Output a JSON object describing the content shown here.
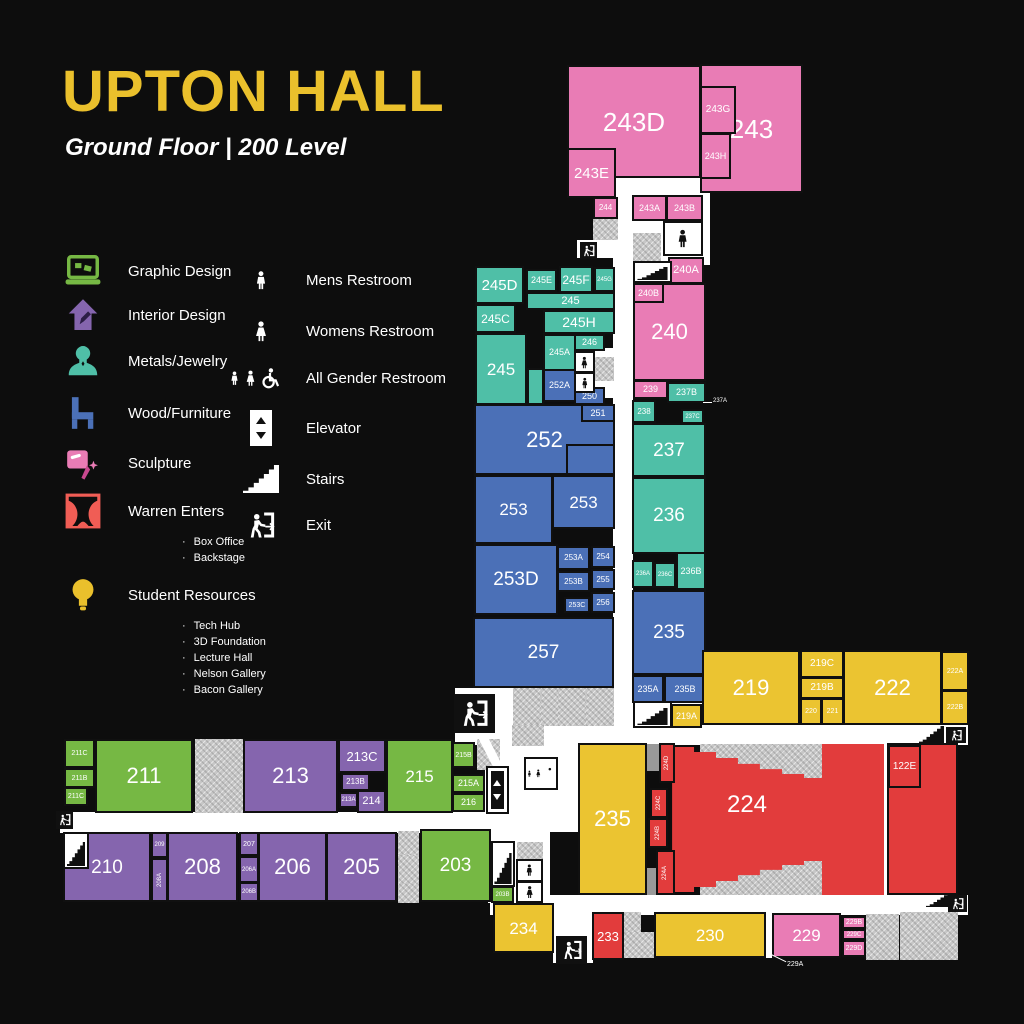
{
  "header": {
    "title": "UPTON HALL",
    "subtitle": "Ground Floor | 200 Level"
  },
  "legend": {
    "programs": [
      {
        "icon": "laptop-icon",
        "label": "Graphic Design",
        "color": "#76b844"
      },
      {
        "icon": "house-icon",
        "label": "Interior Design",
        "color": "#8565ae"
      },
      {
        "icon": "necklace-icon",
        "label": "Metals/Jewelry",
        "color": "#4fbfa7"
      },
      {
        "icon": "chair-icon",
        "label": "Wood/Furniture",
        "color": "#4b70b7"
      },
      {
        "icon": "welding-mask-icon",
        "label": "Sculpture",
        "color": "#e97cb5"
      },
      {
        "icon": "theater-curtain-icon",
        "label": "Warren Enters",
        "color": "#f05d55",
        "subitems": [
          "Box Office",
          "Backstage"
        ]
      },
      {
        "icon": "lightbulb-icon",
        "label": "Student Resources",
        "color": "#eac02c",
        "subitems": [
          "Tech Hub",
          "3D Foundation",
          "Lecture Hall",
          "Nelson Gallery",
          "Bacon Gallery"
        ]
      }
    ],
    "facilities": [
      {
        "icon": "mens-restroom-icon",
        "label": "Mens Restroom"
      },
      {
        "icon": "womens-restroom-icon",
        "label": "Womens Restroom"
      },
      {
        "icon": "all-gender-restroom-icon",
        "label": "All Gender Restroom"
      },
      {
        "icon": "elevator-icon",
        "label": "Elevator"
      },
      {
        "icon": "stairs-icon",
        "label": "Stairs"
      },
      {
        "icon": "exit-icon",
        "label": "Exit"
      }
    ]
  },
  "palette": {
    "pink": "#e97cb5",
    "teal": "#4fbfa7",
    "blue": "#4b70b7",
    "yellow": "#ebc431",
    "green": "#76b844",
    "purple": "#8565ae",
    "red": "#e23c3c",
    "background": "#0d0d0d",
    "corridor": "#ffffff",
    "service": "#c7c7c7"
  },
  "plan": {
    "rooms": [
      [
        "243D",
        567,
        65,
        134,
        113,
        "pink",
        26
      ],
      [
        "243",
        700,
        64,
        103,
        129,
        "pink",
        26
      ],
      [
        "243G",
        700,
        86,
        36,
        48,
        "pink",
        10
      ],
      [
        "243H",
        700,
        133,
        31,
        46,
        "pink",
        9
      ],
      [
        "243E",
        567,
        148,
        49,
        50,
        "pink",
        15
      ],
      [
        "244",
        593,
        197,
        25,
        22,
        "pink",
        8
      ],
      [
        "243A",
        632,
        195,
        35,
        26,
        "pink",
        9
      ],
      [
        "243B",
        666,
        195,
        37,
        26,
        "pink",
        9
      ],
      [
        "240A",
        668,
        257,
        36,
        27,
        "pink",
        11
      ],
      [
        "240",
        633,
        283,
        73,
        98,
        "pink",
        22
      ],
      [
        "240B",
        633,
        283,
        31,
        20,
        "pink",
        9
      ],
      [
        "239",
        633,
        380,
        35,
        19,
        "pink",
        9
      ],
      [
        "245D",
        475,
        266,
        49,
        38,
        "teal",
        15
      ],
      [
        "245E",
        526,
        269,
        31,
        23,
        "teal",
        9
      ],
      [
        "245F",
        559,
        266,
        34,
        27,
        "teal",
        12
      ],
      [
        "245G",
        594,
        267,
        21,
        25,
        "teal",
        6
      ],
      [
        "245",
        526,
        292,
        89,
        18,
        "teal",
        11
      ],
      [
        "245C",
        475,
        304,
        41,
        29,
        "teal",
        12
      ],
      [
        "245H",
        543,
        310,
        72,
        24,
        "teal",
        14
      ],
      [
        "245A",
        543,
        334,
        33,
        37,
        "teal",
        9
      ],
      [
        "246",
        574,
        334,
        31,
        17,
        "teal",
        9
      ],
      [
        "245",
        475,
        333,
        52,
        72,
        "teal",
        17
      ],
      [
        "",
        527,
        368,
        17,
        37,
        "teal",
        0
      ],
      [
        "237B",
        667,
        382,
        39,
        21,
        "teal",
        9
      ],
      [
        "238",
        632,
        400,
        24,
        23,
        "teal",
        8
      ],
      [
        "237C",
        681,
        409,
        23,
        15,
        "teal",
        6
      ],
      [
        "237",
        632,
        423,
        74,
        54,
        "teal",
        19
      ],
      [
        "236",
        632,
        477,
        74,
        77,
        "teal",
        19
      ],
      [
        "236A",
        632,
        560,
        22,
        28,
        "teal",
        6
      ],
      [
        "236C",
        654,
        562,
        22,
        26,
        "teal",
        6
      ],
      [
        "236B",
        676,
        552,
        30,
        38,
        "teal",
        9
      ],
      [
        "252A",
        543,
        369,
        33,
        33,
        "blue",
        9
      ],
      [
        "250",
        574,
        387,
        31,
        18,
        "blue",
        9
      ],
      [
        "252",
        474,
        404,
        141,
        71,
        "blue",
        22
      ],
      [
        "251",
        581,
        404,
        34,
        18,
        "blue",
        9
      ],
      [
        "",
        566,
        444,
        49,
        31,
        "blue",
        0
      ],
      [
        "253",
        474,
        475,
        79,
        69,
        "blue",
        17
      ],
      [
        "253",
        552,
        475,
        63,
        54,
        "blue",
        17
      ],
      [
        "253D",
        474,
        544,
        84,
        71,
        "blue",
        19
      ],
      [
        "253A",
        557,
        546,
        33,
        24,
        "blue",
        8
      ],
      [
        "254",
        591,
        546,
        24,
        22,
        "blue",
        8
      ],
      [
        "253B",
        557,
        571,
        33,
        21,
        "blue",
        8
      ],
      [
        "255",
        591,
        569,
        24,
        21,
        "blue",
        8
      ],
      [
        "253C",
        564,
        597,
        26,
        16,
        "blue",
        7
      ],
      [
        "256",
        591,
        592,
        24,
        21,
        "blue",
        8
      ],
      [
        "257",
        473,
        617,
        141,
        71,
        "blue",
        19
      ],
      [
        "235",
        632,
        590,
        74,
        85,
        "blue",
        19
      ],
      [
        "235A",
        632,
        675,
        32,
        28,
        "blue",
        9
      ],
      [
        "235B",
        664,
        675,
        42,
        28,
        "blue",
        9
      ],
      [
        "219A",
        671,
        704,
        31,
        24,
        "yellow",
        9
      ],
      [
        "219",
        702,
        650,
        98,
        75,
        "yellow",
        22
      ],
      [
        "219C",
        800,
        650,
        44,
        28,
        "yellow",
        10
      ],
      [
        "219B",
        800,
        677,
        44,
        22,
        "yellow",
        10
      ],
      [
        "220",
        800,
        698,
        22,
        27,
        "yellow",
        7
      ],
      [
        "221",
        821,
        698,
        23,
        27,
        "yellow",
        7
      ],
      [
        "222",
        843,
        650,
        99,
        75,
        "yellow",
        22
      ],
      [
        "222A",
        941,
        651,
        28,
        40,
        "yellow",
        7
      ],
      [
        "222B",
        941,
        690,
        28,
        35,
        "yellow",
        7
      ],
      [
        "211C",
        64,
        739,
        31,
        29,
        "green",
        7
      ],
      [
        "211B",
        64,
        768,
        31,
        20,
        "green",
        7
      ],
      [
        "211C",
        64,
        787,
        24,
        19,
        "green",
        7
      ],
      [
        "211",
        95,
        739,
        98,
        74,
        "green",
        22
      ],
      [
        "213",
        243,
        739,
        95,
        74,
        "purple",
        22
      ],
      [
        "213C",
        338,
        739,
        48,
        34,
        "purple",
        13
      ],
      [
        "213B",
        341,
        773,
        29,
        18,
        "purple",
        8
      ],
      [
        "213A",
        339,
        792,
        19,
        16,
        "purple",
        6
      ],
      [
        "214",
        357,
        790,
        29,
        23,
        "purple",
        11
      ],
      [
        "215",
        386,
        739,
        67,
        74,
        "green",
        17
      ],
      [
        "215B",
        452,
        742,
        23,
        26,
        "green",
        7
      ],
      [
        "215A",
        452,
        774,
        33,
        19,
        "green",
        9
      ],
      [
        "216",
        452,
        793,
        33,
        19,
        "green",
        9
      ],
      [
        "210",
        63,
        832,
        88,
        70,
        "purple",
        19
      ],
      [
        "209",
        151,
        832,
        17,
        26,
        "purple",
        6
      ],
      [
        "208A",
        151,
        858,
        17,
        44,
        "purple",
        6,
        "r"
      ],
      [
        "208",
        167,
        832,
        71,
        70,
        "purple",
        22
      ],
      [
        "207",
        239,
        832,
        20,
        24,
        "purple",
        7
      ],
      [
        "206A",
        239,
        856,
        20,
        27,
        "purple",
        6
      ],
      [
        "206B",
        239,
        882,
        20,
        20,
        "purple",
        6
      ],
      [
        "206",
        258,
        832,
        69,
        70,
        "purple",
        22
      ],
      [
        "205",
        326,
        832,
        71,
        70,
        "purple",
        22
      ],
      [
        "203",
        420,
        829,
        71,
        73,
        "green",
        19
      ],
      [
        "203B",
        491,
        886,
        23,
        17,
        "green",
        6
      ],
      [
        "234",
        493,
        903,
        61,
        50,
        "yellow",
        17
      ],
      [
        "235",
        578,
        743,
        69,
        152,
        "yellow",
        22
      ],
      [
        "",
        887,
        743,
        71,
        152,
        "red",
        0
      ],
      [
        "122E",
        888,
        745,
        33,
        43,
        "red",
        10
      ],
      [
        "224D",
        659,
        743,
        16,
        40,
        "red",
        6,
        "r"
      ],
      [
        "224C",
        650,
        788,
        18,
        30,
        "red",
        6,
        "r"
      ],
      [
        "224B",
        648,
        818,
        20,
        30,
        "red",
        6,
        "r"
      ],
      [
        "224A",
        656,
        850,
        19,
        45,
        "red",
        6,
        "r"
      ],
      [
        "233",
        592,
        912,
        32,
        48,
        "red",
        13
      ],
      [
        "230",
        654,
        912,
        112,
        46,
        "yellow",
        17
      ],
      [
        "229",
        772,
        913,
        69,
        45,
        "pink",
        17
      ],
      [
        "229B",
        842,
        916,
        24,
        13,
        "pink",
        7
      ],
      [
        "229C",
        842,
        929,
        24,
        11,
        "pink",
        6
      ],
      [
        "229D",
        842,
        940,
        24,
        17,
        "pink",
        7
      ]
    ],
    "labels": [
      {
        "label": "224",
        "x": 702,
        "y": 790,
        "w": 90,
        "h": 30,
        "fs": 24
      }
    ],
    "corridors": [
      [
        615,
        178,
        95,
        87
      ],
      [
        613,
        253,
        20,
        477
      ],
      [
        455,
        688,
        513,
        57
      ],
      [
        60,
        812,
        460,
        21
      ],
      [
        490,
        895,
        478,
        20
      ],
      [
        485,
        740,
        95,
        92
      ],
      [
        488,
        830,
        62,
        73
      ],
      [
        883,
        744,
        5,
        151
      ],
      [
        766,
        913,
        7,
        45
      ],
      [
        553,
        895,
        40,
        68
      ],
      [
        573,
        348,
        42,
        50
      ],
      [
        577,
        240,
        38,
        18
      ]
    ],
    "white_rooms": [
      [
        196,
        763,
        29,
        32
      ],
      [
        225,
        763,
        20,
        30
      ]
    ],
    "hatches": [
      [
        633,
        233,
        28,
        33
      ],
      [
        593,
        218,
        25,
        22
      ],
      [
        595,
        357,
        19,
        24
      ],
      [
        513,
        688,
        29,
        38
      ],
      [
        541,
        688,
        18,
        38
      ],
      [
        558,
        688,
        29,
        38
      ],
      [
        586,
        688,
        28,
        38
      ],
      [
        512,
        725,
        32,
        21
      ],
      [
        195,
        739,
        49,
        74
      ],
      [
        398,
        831,
        21,
        25
      ],
      [
        398,
        855,
        21,
        30
      ],
      [
        398,
        884,
        21,
        19
      ],
      [
        477,
        739,
        23,
        31
      ],
      [
        517,
        842,
        26,
        18
      ],
      [
        623,
        912,
        18,
        21
      ],
      [
        623,
        932,
        31,
        26
      ],
      [
        866,
        914,
        33,
        46
      ],
      [
        900,
        912,
        58,
        48
      ],
      [
        700,
        744,
        122,
        37
      ],
      [
        700,
        858,
        122,
        37
      ]
    ],
    "dark_hatches": [
      [
        647,
        744,
        28,
        27
      ],
      [
        647,
        868,
        28,
        27
      ]
    ],
    "diagonals": [
      {
        "x": 489,
        "y": 733,
        "w": 9,
        "h": 50,
        "rot": -27
      }
    ],
    "fan": {
      "x": 660,
      "y": 744,
      "w": 224,
      "h": 151
    },
    "icons": [
      [
        "man",
        663,
        221,
        40,
        35,
        "c"
      ],
      [
        "stairs",
        633,
        261,
        39,
        22,
        "c"
      ],
      [
        "exit",
        580,
        242,
        17,
        17,
        "d"
      ],
      [
        "woman",
        574,
        351,
        21,
        22,
        "c"
      ],
      [
        "man",
        574,
        372,
        21,
        21,
        "c"
      ],
      [
        "stairs",
        633,
        701,
        39,
        27,
        "c"
      ],
      [
        "exit",
        454,
        694,
        41,
        39,
        "d"
      ],
      [
        "elevator",
        486,
        766,
        23,
        48,
        "c"
      ],
      [
        "allgender",
        524,
        757,
        34,
        33,
        "c"
      ],
      [
        "stairs",
        63,
        832,
        26,
        37,
        "c"
      ],
      [
        "exit",
        56,
        811,
        17,
        18,
        "d"
      ],
      [
        "stairs",
        491,
        841,
        24,
        46,
        "c"
      ],
      [
        "man",
        516,
        859,
        27,
        23,
        "c"
      ],
      [
        "woman",
        516,
        881,
        27,
        22,
        "c"
      ],
      [
        "exit",
        556,
        936,
        31,
        28,
        "d"
      ],
      [
        "stairs",
        919,
        726,
        25,
        17,
        "b"
      ],
      [
        "exit",
        946,
        727,
        20,
        16,
        "d"
      ],
      [
        "stairs",
        926,
        893,
        25,
        14,
        "b"
      ],
      [
        "exit",
        948,
        895,
        19,
        17,
        "d"
      ]
    ],
    "callouts": [
      {
        "label": "237A",
        "tx": 713,
        "ty": 398,
        "fs": 6,
        "line": {
          "x": 703,
          "y": 402,
          "len": 9,
          "rot": 0
        }
      },
      {
        "label": "229A",
        "tx": 787,
        "ty": 961,
        "fs": 7,
        "line": {
          "x": 769,
          "y": 953,
          "len": 19,
          "rot": 26
        }
      }
    ]
  }
}
